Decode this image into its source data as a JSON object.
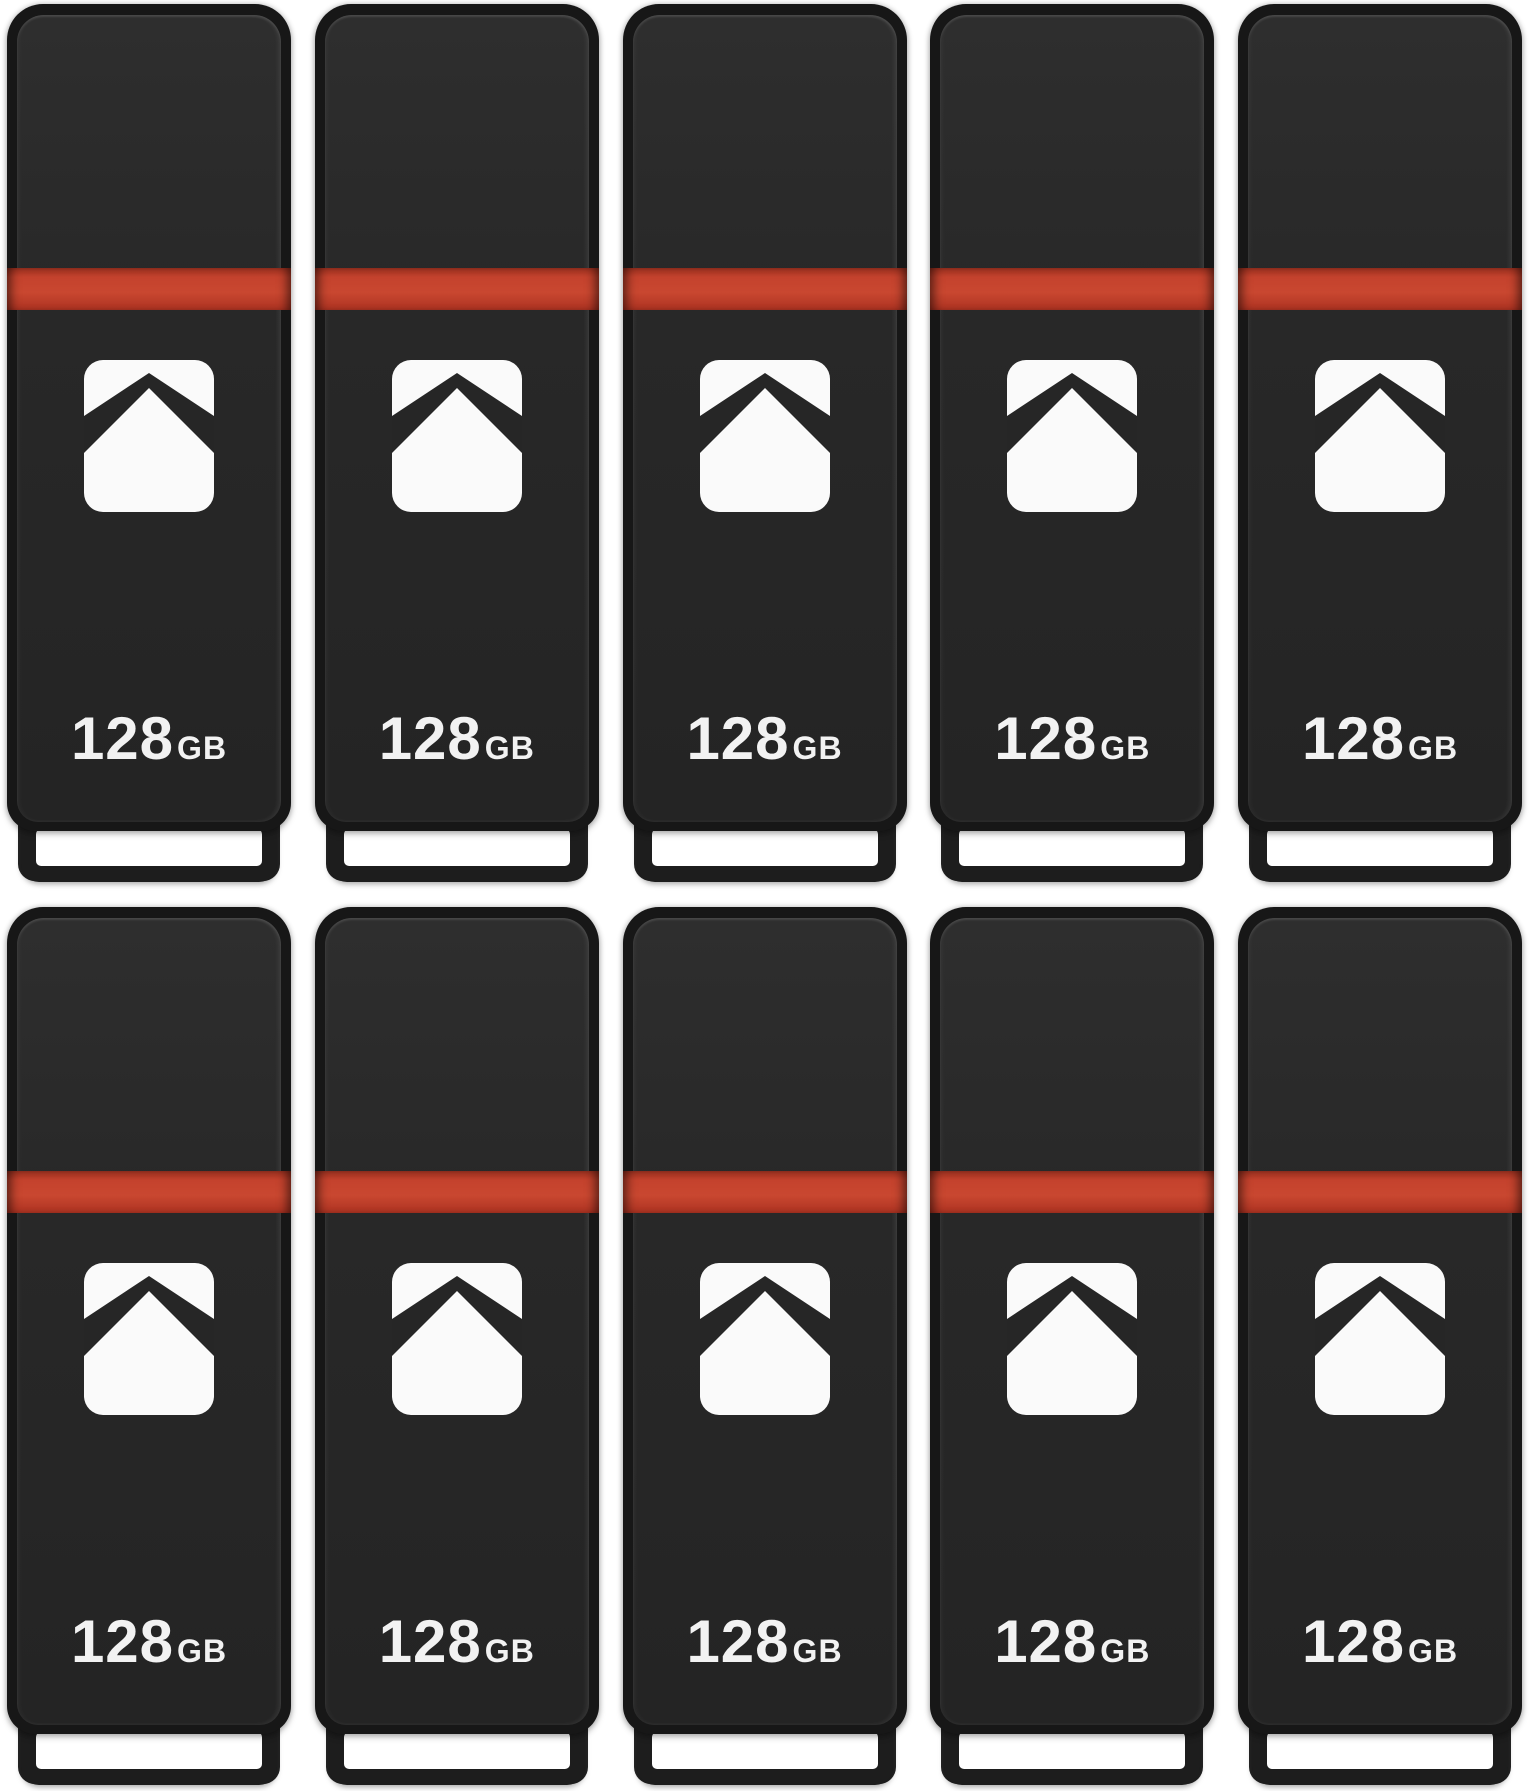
{
  "grid": {
    "rows": 2,
    "columns": 5,
    "count": 10
  },
  "colors": {
    "background": "#ffffff",
    "drive_body": "#272727",
    "drive_rim": "#171717",
    "stripe_red": "#c5432e",
    "logo_white": "#fafafa",
    "capacity_text": "#f2f2f2",
    "slot_white": "#ffffff",
    "cap_frame": "#1d1d1d"
  },
  "icons": {
    "brand_logo": "up-arrow-house-icon"
  },
  "drives": [
    {
      "capacity": "128",
      "unit": "GB"
    },
    {
      "capacity": "128",
      "unit": "GB"
    },
    {
      "capacity": "128",
      "unit": "GB"
    },
    {
      "capacity": "128",
      "unit": "GB"
    },
    {
      "capacity": "128",
      "unit": "GB"
    },
    {
      "capacity": "128",
      "unit": "GB"
    },
    {
      "capacity": "128",
      "unit": "GB"
    },
    {
      "capacity": "128",
      "unit": "GB"
    },
    {
      "capacity": "128",
      "unit": "GB"
    },
    {
      "capacity": "128",
      "unit": "GB"
    }
  ]
}
